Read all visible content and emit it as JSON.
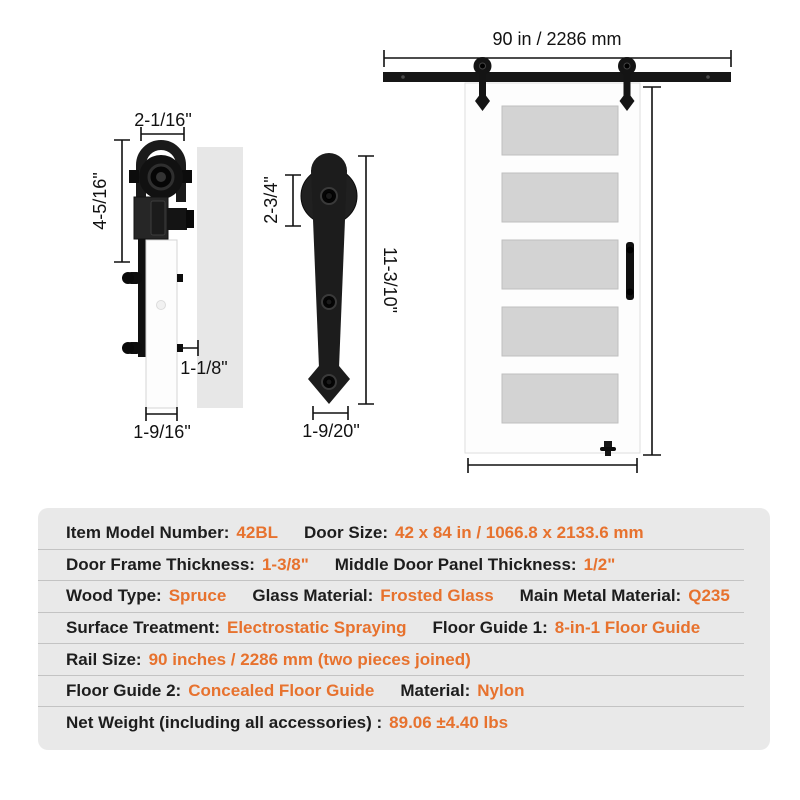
{
  "colors": {
    "accent_orange": "#E7722E",
    "table_background": "#E9E9E9",
    "hardware_black": "#1A1A1A",
    "glass_gray": "#D2D2D2"
  },
  "dimensions": {
    "roller_side_view": {
      "strap_width": "2-1/16\"",
      "assembly_height": "4-5/16\"",
      "bolt_protrusion": "1-1/8\"",
      "board_thickness": "1-9/16\""
    },
    "hanger_front_view": {
      "wheel_diameter": "2-3/4\"",
      "length": "11-3/10\"",
      "bottom_width": "1-9/20\""
    },
    "door_assembly": {
      "rail_length": "90 in / 2286 mm",
      "door_height": "84 in / 2133.6 mm",
      "door_width": "42 in / 1066.8 mm"
    }
  },
  "specs": {
    "rows": [
      {
        "pairs": [
          {
            "label": "Item Model Number:",
            "value": "42BL"
          },
          {
            "label": "Door Size:",
            "value": "42 x 84 in / 1066.8 x 2133.6 mm"
          }
        ]
      },
      {
        "pairs": [
          {
            "label": "Door Frame Thickness:",
            "value": "1-3/8\""
          },
          {
            "label": "Middle Door Panel Thickness:",
            "value": "1/2\""
          }
        ]
      },
      {
        "pairs": [
          {
            "label": "Wood Type:",
            "value": "Spruce"
          },
          {
            "label": "Glass Material:",
            "value": "Frosted Glass"
          },
          {
            "label": "Main Metal Material:",
            "value": "Q235"
          }
        ]
      },
      {
        "pairs": [
          {
            "label": "Surface Treatment:",
            "value": "Electrostatic Spraying"
          },
          {
            "label": "Floor Guide 1:",
            "value": "8-in-1 Floor Guide"
          }
        ]
      },
      {
        "pairs": [
          {
            "label": "Rail Size:",
            "value": "90 inches / 2286 mm (two pieces joined)"
          }
        ]
      },
      {
        "pairs": [
          {
            "label": "Floor Guide 2:",
            "value": "Concealed Floor Guide"
          },
          {
            "label": "Material:",
            "value": "Nylon"
          }
        ]
      },
      {
        "pairs": [
          {
            "label": "Net Weight (including all accessories) :",
            "value": "89.06 ±4.40 lbs"
          }
        ]
      }
    ]
  }
}
